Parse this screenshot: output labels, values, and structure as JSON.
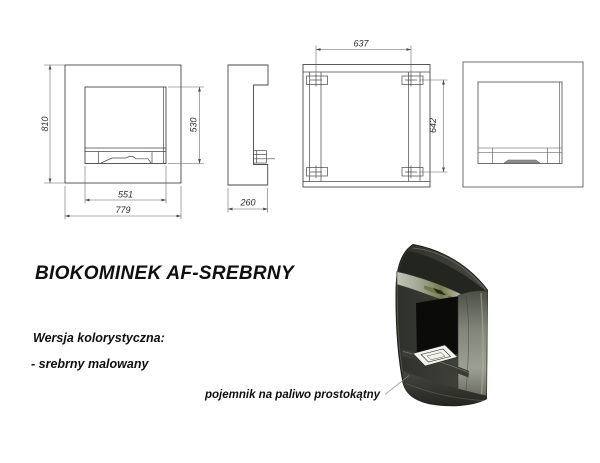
{
  "product": {
    "title": "BIOKOMINEK AF-SREBRNY",
    "color_section_heading": "Wersja kolorystyczna:",
    "color_options": [
      "- srebrny malowany"
    ],
    "callout_label": "pojemnik na paliwo prostokątny"
  },
  "dimensions_mm": {
    "overall_height": "810",
    "glass_height": "530",
    "glass_width": "551",
    "overall_width": "779",
    "depth": "260",
    "mount_spacing_width": "637",
    "mount_spacing_height": "642"
  },
  "colors": {
    "background": "#ffffff",
    "drawing_line": "#474747",
    "dimension_line": "#5f5f5f",
    "text": "#0f0f0f",
    "render_body": "#33352e",
    "render_panel": "#8f9384",
    "render_olive_accent": "#6d7340",
    "render_fuel_tray": "#f2f2ee"
  }
}
